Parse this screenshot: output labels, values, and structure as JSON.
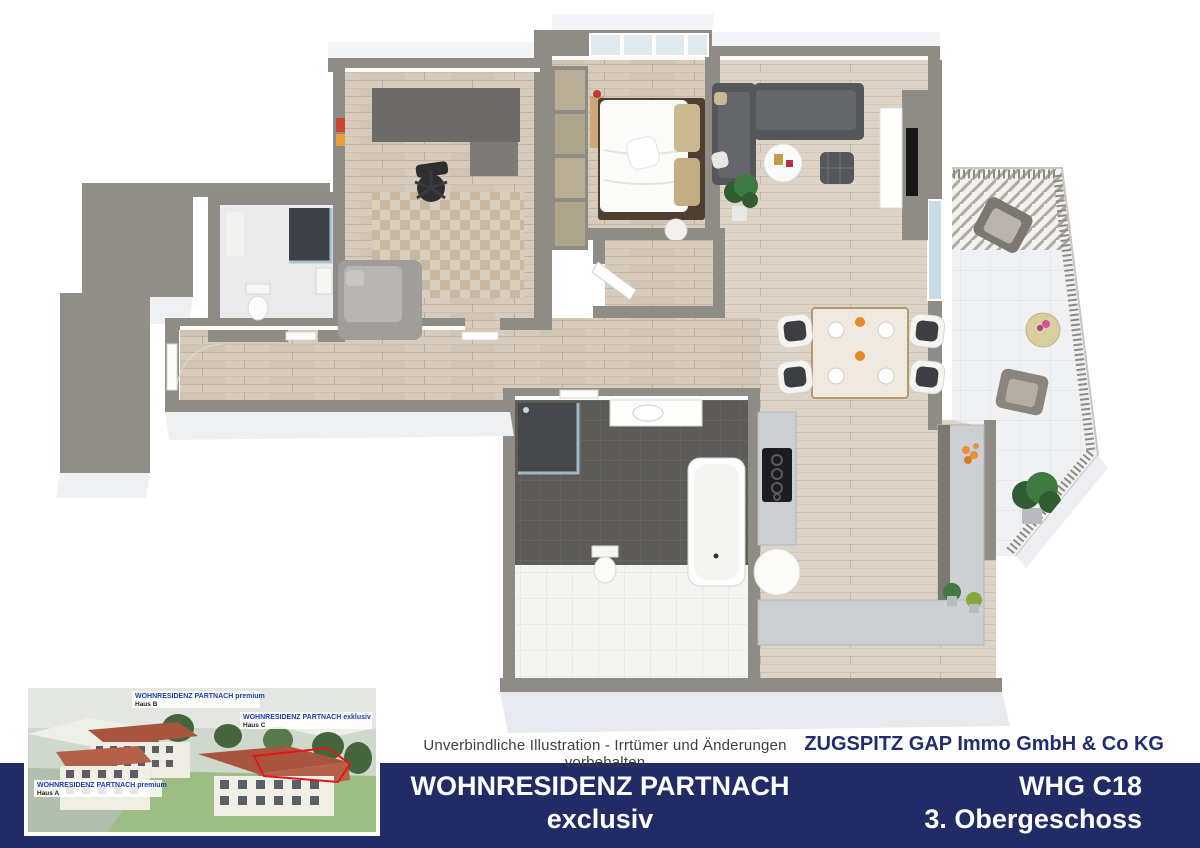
{
  "footer": {
    "disclaimer": "Unverbindliche Illustration - Irrtümer und Änderungen vorbehalten",
    "company": "ZUGSPITZ GAP Immo GmbH & Co KG",
    "project_title": "WOHNRESIDENZ PARTNACH",
    "project_subtitle": "exclusiv",
    "unit": "WHG C18",
    "floor": "3. Obergeschoss",
    "bar_color": "#212b66",
    "company_color": "#222c6e",
    "disclaimer_color": "#3f3f3f"
  },
  "inset": {
    "labels": {
      "haus_b": {
        "title": "WOHNRESIDENZ PARTNACH premium",
        "name": "Haus B"
      },
      "haus_c": {
        "title": "WOHNRESIDENZ PARTNACH exklusiv",
        "name": "Haus C"
      },
      "haus_a": {
        "title": "WOHNRESIDENZ PARTNACH premium",
        "name": "Haus A"
      }
    },
    "highlight_outline_color": "#e51515",
    "label_text_color": "#1b3faa"
  },
  "floorplan": {
    "colors": {
      "wall": "#8f8c85",
      "wall_face": "#f4f5f6",
      "wood_floor": "#d6cbbc",
      "dark_tile": "#5c5b58",
      "white_tile": "#f4f4f2",
      "terrace_tile": "#f0f1f3",
      "sofa": "#55575a",
      "neighbor_block": "#918e88",
      "window_glass": "#dfe9ef"
    }
  }
}
